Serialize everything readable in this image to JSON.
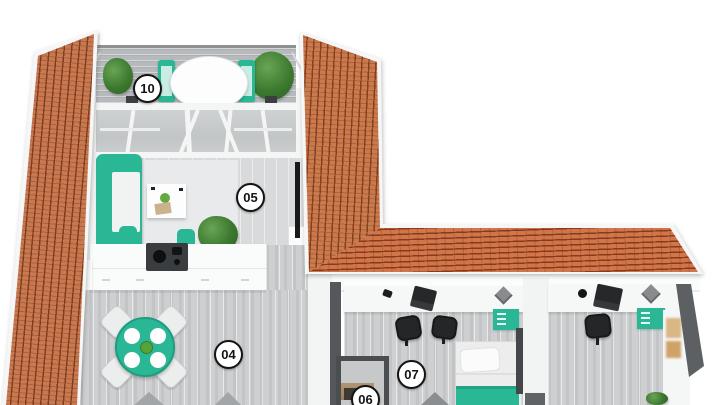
{
  "scene": {
    "description": "3D top-down apartment floor plan render",
    "room_markers": [
      {
        "label": "10"
      },
      {
        "label": "05"
      },
      {
        "label": "04"
      },
      {
        "label": "07"
      },
      {
        "label": "06"
      }
    ],
    "palette": {
      "background": "#ffffff",
      "roof_tile": "#cb7a4d",
      "roof_tile_dark": "#7d3a1a",
      "accent_teal": "#2ab795",
      "floor_light": "#d8dadb",
      "floor_mid": "#cdcfd1",
      "wall_white": "#f4f5f5",
      "wall_dark_gray": "#55585a",
      "fixture_black": "#242628"
    }
  }
}
